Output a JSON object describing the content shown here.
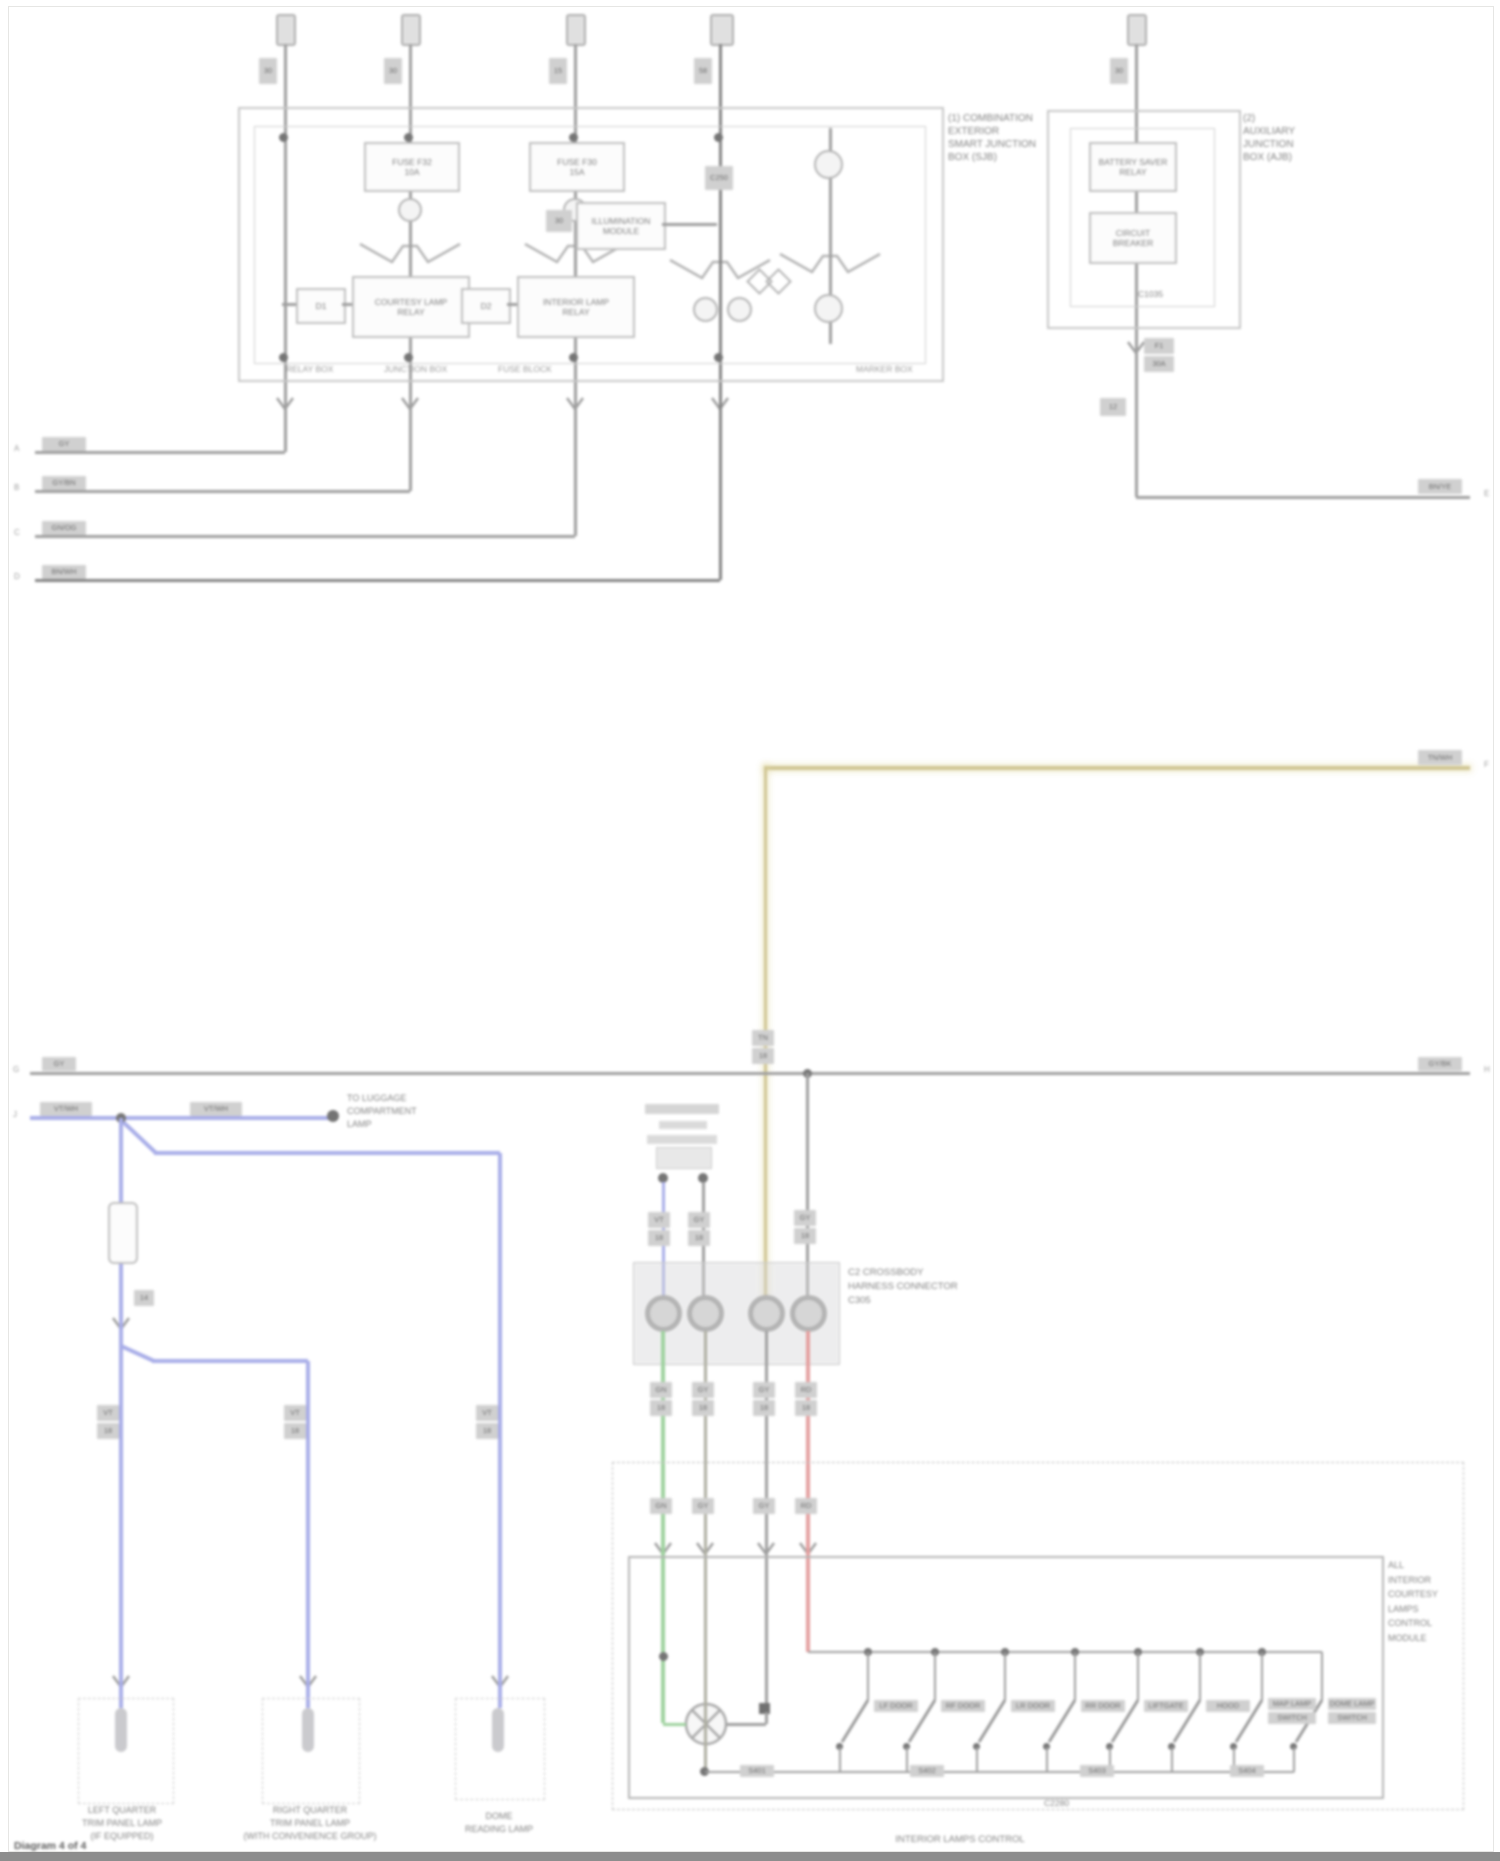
{
  "page": {
    "watermark": "Diagram 4 of 4"
  },
  "colors": {
    "wire": "#8f8f8f",
    "blue": "#9aa0e4",
    "tan": "#c8bc82",
    "green": "#8fca8f",
    "red": "#e09090",
    "olive": "#a2a293",
    "text": "#6e6e6e"
  },
  "feeds": {
    "tags": [
      "30",
      "30",
      "15",
      "58",
      "30"
    ]
  },
  "sjb": {
    "label": [
      "(1) COMBINATION",
      "EXTERIOR",
      "SMART JUNCTION",
      "BOX (SJB)"
    ],
    "sections": [
      "RELAY BOX",
      "JUNCTION BOX",
      "FUSE BLOCK",
      "MARKER BOX"
    ],
    "fuse2": {
      "l1": "FUSE F32",
      "l2": "10A"
    },
    "fuse3": {
      "l1": "FUSE F30",
      "l2": "15A"
    },
    "relay2": {
      "l1": "COURTESY LAMP",
      "l2": "RELAY"
    },
    "relay3": {
      "l1": "INTERIOR LAMP",
      "l2": "RELAY"
    },
    "diode2": "D1",
    "diode3": "D2",
    "mod4": {
      "l1": "ILLUMINATION",
      "l2": "MODULE"
    },
    "tag4": "30",
    "conn4": "C250"
  },
  "ajb": {
    "label": [
      "(2)",
      "AUXILIARY",
      "JUNCTION",
      "BOX (AJB)"
    ],
    "relay": {
      "l1": "BATTERY SAVER",
      "l2": "RELAY"
    },
    "breaker": {
      "l1": "CIRCUIT",
      "l2": "BREAKER"
    },
    "conn": "C1035",
    "tag1": "F1",
    "tag2": "30A",
    "tag3": "12",
    "out": {
      "code": "BN/YE",
      "pin": "E"
    }
  },
  "left_wires": [
    {
      "code": "GY",
      "pin": "A"
    },
    {
      "code": "GY/BN",
      "pin": "B"
    },
    {
      "code": "GN/OG",
      "pin": "C"
    },
    {
      "code": "BN/WH",
      "pin": "D"
    }
  ],
  "tan_wire": {
    "code": "TN/WH",
    "pin": "F",
    "t1": "TN",
    "t2": "18"
  },
  "gray_wire": {
    "lcode": "GY",
    "lpin": "G",
    "rcode": "GY/BK",
    "rpin": "H",
    "t1": "GY",
    "t2": "18"
  },
  "blue_net": {
    "c1": "VT/WH",
    "c2": "VT/WH",
    "pin": "J",
    "conn": "14",
    "splice": [
      "TO LUGGAGE",
      "COMPARTMENT",
      "LAMP"
    ],
    "drop1": [
      "VT",
      "18"
    ],
    "drop2": [
      "VT",
      "18"
    ],
    "drop3": [
      "VT",
      "18"
    ]
  },
  "center": {
    "conn_label": [
      "C2 CROSSBODY",
      "HARNESS CONNECTOR",
      "C305"
    ],
    "above": [
      [
        "VT",
        "18"
      ],
      [
        "GY",
        "18"
      ],
      [
        "TN",
        "18"
      ],
      [
        "GY",
        "18"
      ]
    ],
    "below": [
      [
        "GN",
        "18"
      ],
      [
        "GY",
        "18"
      ],
      [
        "GY",
        "18"
      ],
      [
        "RD",
        "18"
      ]
    ]
  },
  "module": {
    "side_label": [
      "ALL",
      "INTERIOR",
      "COURTESY",
      "LAMPS",
      "CONTROL",
      "MODULE"
    ],
    "bottom_label": "INTERIOR LAMPS CONTROL",
    "conn": "C2280",
    "switches": [
      {
        "l1": "LF DOOR",
        "l2": ""
      },
      {
        "l1": "RF DOOR",
        "l2": ""
      },
      {
        "l1": "LR DOOR",
        "l2": ""
      },
      {
        "l1": "RR DOOR",
        "l2": ""
      },
      {
        "l1": "LIFTGATE",
        "l2": ""
      },
      {
        "l1": "HOOD",
        "l2": ""
      },
      {
        "l1": "MAP LAMP",
        "l2": "SWITCH"
      },
      {
        "l1": "DOME LAMP",
        "l2": "SWITCH"
      }
    ],
    "splices": [
      "S401",
      "S402",
      "S403",
      "S404"
    ]
  },
  "lamps": [
    {
      "l1": "LEFT QUARTER",
      "l2": "TRIM PANEL LAMP",
      "l3": "(IF EQUIPPED)"
    },
    {
      "l1": "RIGHT QUARTER",
      "l2": "TRIM PANEL LAMP",
      "l3": "(WITH CONVENIENCE GROUP)"
    },
    {
      "l1": "DOME",
      "l2": "READING LAMP",
      "l3": ""
    }
  ]
}
